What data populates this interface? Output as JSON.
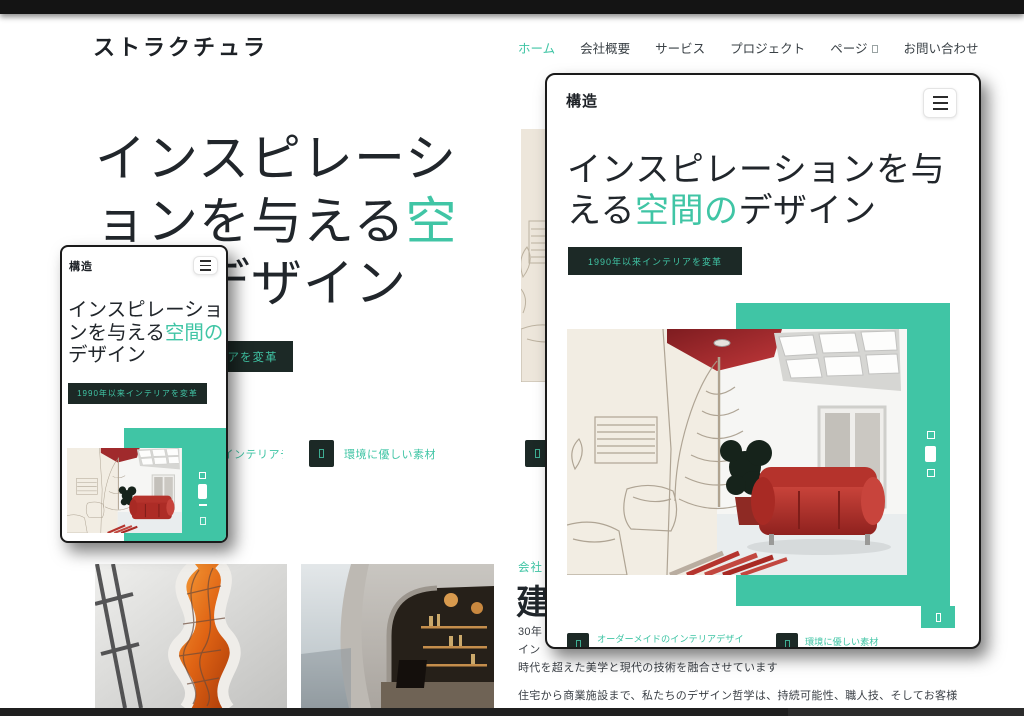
{
  "header": {
    "brand": "ストラクチュラ",
    "nav": [
      {
        "label": "ホーム",
        "active": true
      },
      {
        "label": "会社概要"
      },
      {
        "label": "サービス"
      },
      {
        "label": "プロジェクト"
      },
      {
        "label": "ページ",
        "has_dropdown": true
      },
      {
        "label": "お問い合わせ"
      }
    ]
  },
  "hero": {
    "title_pre": "インスピレーションを与える",
    "title_accent": "空間の",
    "title_post": "デザイン",
    "badge": "1990年以来インテリアを変革",
    "features": [
      {
        "label": "オーダーメイドのインテリアデザイン"
      },
      {
        "label": "環境に優しい素材"
      }
    ]
  },
  "mockups": {
    "logo": "構造"
  },
  "about": {
    "label_visible": "会社",
    "heading_visible": "建",
    "para1_line1": "30年",
    "para1_line2": "イン",
    "para1_line3": "時代を超えた美学と現代の技術を融合させています",
    "para2": "住宅から商業施設まで、私たちのデザイン哲学は、持続可能性、職人技、そしてお客様"
  },
  "colors": {
    "accent": "#40C5A5",
    "badge_bg": "#1C2926",
    "ink": "#21262B",
    "sofa_red": "#BE3430"
  }
}
